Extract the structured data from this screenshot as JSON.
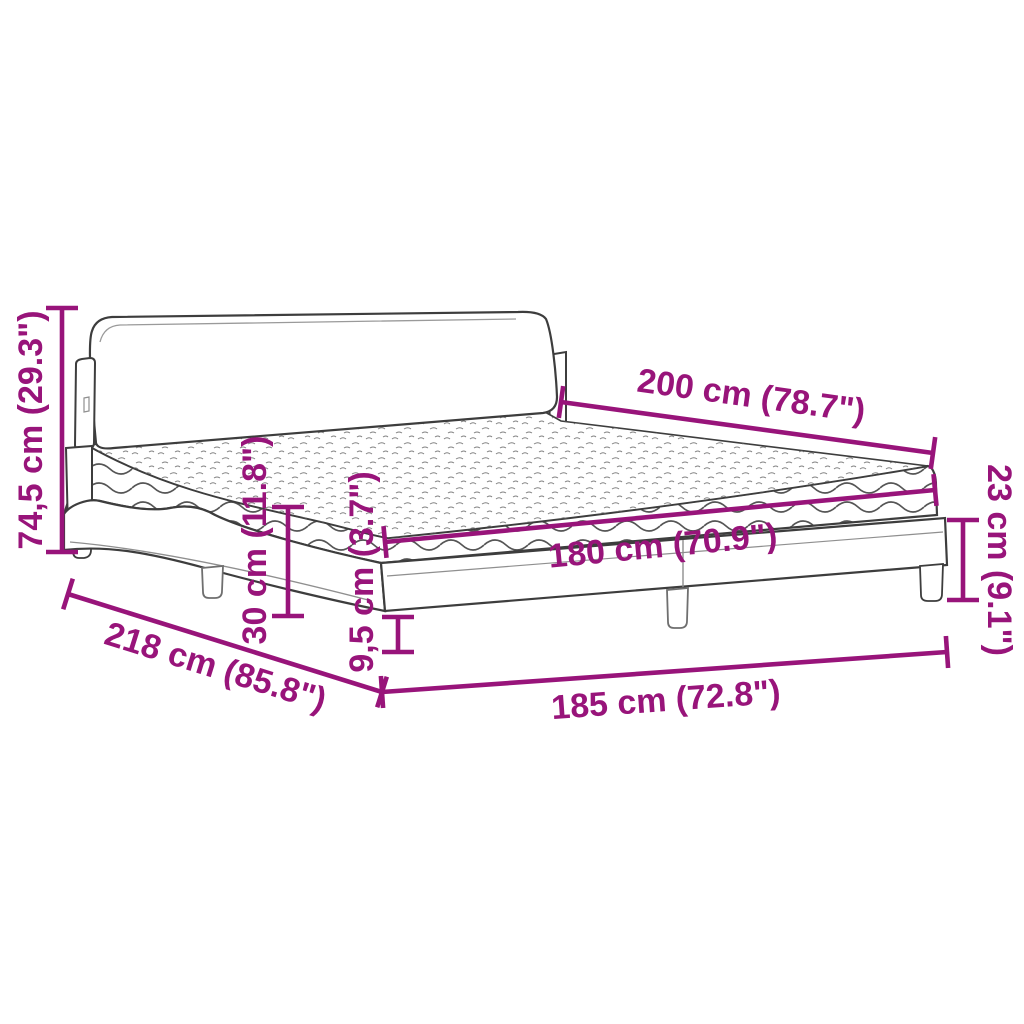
{
  "diagram": {
    "title": "Bed with mattress dimension diagram",
    "colors": {
      "dimension_accent": "#98147A",
      "line_dark": "#3d3d3d",
      "line_light": "#8f8f8f",
      "background": "#ffffff"
    },
    "dimensions": [
      {
        "id": "total-height",
        "label": "74,5 cm (29.3\")"
      },
      {
        "id": "mattress-length",
        "label": "200 cm (78.7\")"
      },
      {
        "id": "frame-height",
        "label": "23 cm (9.1\")"
      },
      {
        "id": "mattress-width",
        "label": "180 cm (70.9\")"
      },
      {
        "id": "mattress-height",
        "label": "30 cm (11.8\")"
      },
      {
        "id": "rail-step-height",
        "label": "9,5 cm (3.7\")"
      },
      {
        "id": "bed-length",
        "label": "218 cm (85.8\")"
      },
      {
        "id": "bed-width",
        "label": "185 cm (72.8\")"
      }
    ]
  }
}
